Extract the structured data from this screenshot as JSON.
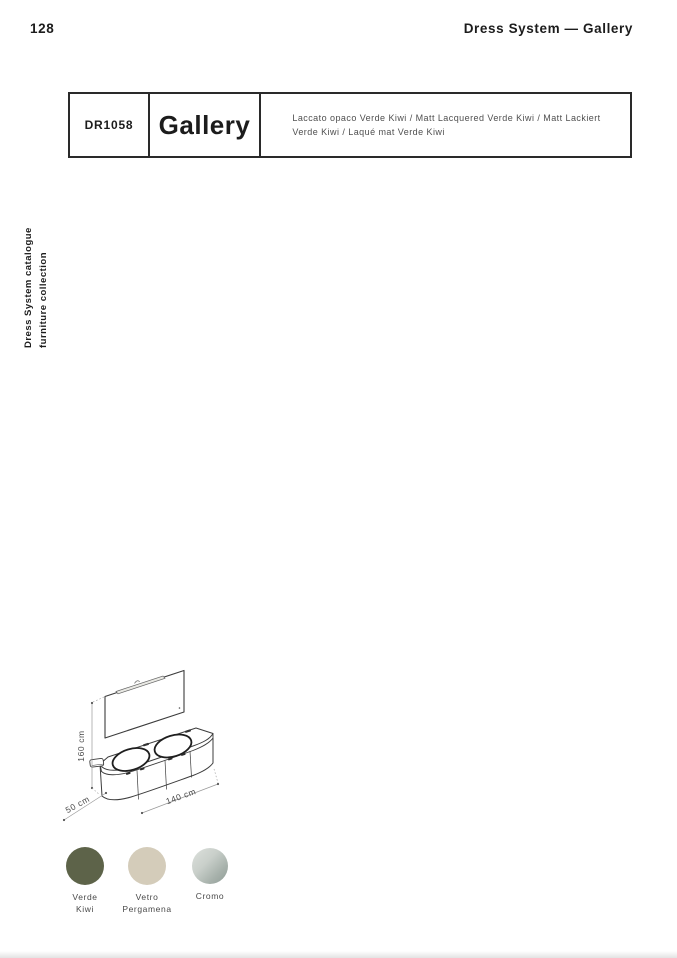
{
  "page": {
    "number": "128",
    "header_right": "Dress System — Gallery",
    "sidebar_caption": "Dress System catalogue\nfurniture collection"
  },
  "product": {
    "code": "DR1058",
    "name": "Gallery",
    "description": "Laccato opaco Verde Kiwi / Matt Lacquered Verde Kiwi / Matt Lackiert\nVerde Kiwi / Laqué mat Verde Kiwi"
  },
  "drawing": {
    "dim_height": "160 cm",
    "dim_depth": "50 cm",
    "dim_width": "140 cm"
  },
  "swatches": [
    {
      "label": "Verde\nKiwi",
      "css": "#5d6349"
    },
    {
      "label": "Vetro\nPergamena",
      "css": "#d4ccba"
    },
    {
      "label": "Cromo",
      "css": "linear-gradient(135deg, #dde1dd 0%, #c9cfca 40%, #a9b3ad 70%, #8e9b95 100%)"
    }
  ],
  "colors": {
    "box_border": "#2a2a2a",
    "text_primary": "#1c1c1c",
    "text_secondary": "#4f4f4f",
    "dim_line": "#999999"
  }
}
